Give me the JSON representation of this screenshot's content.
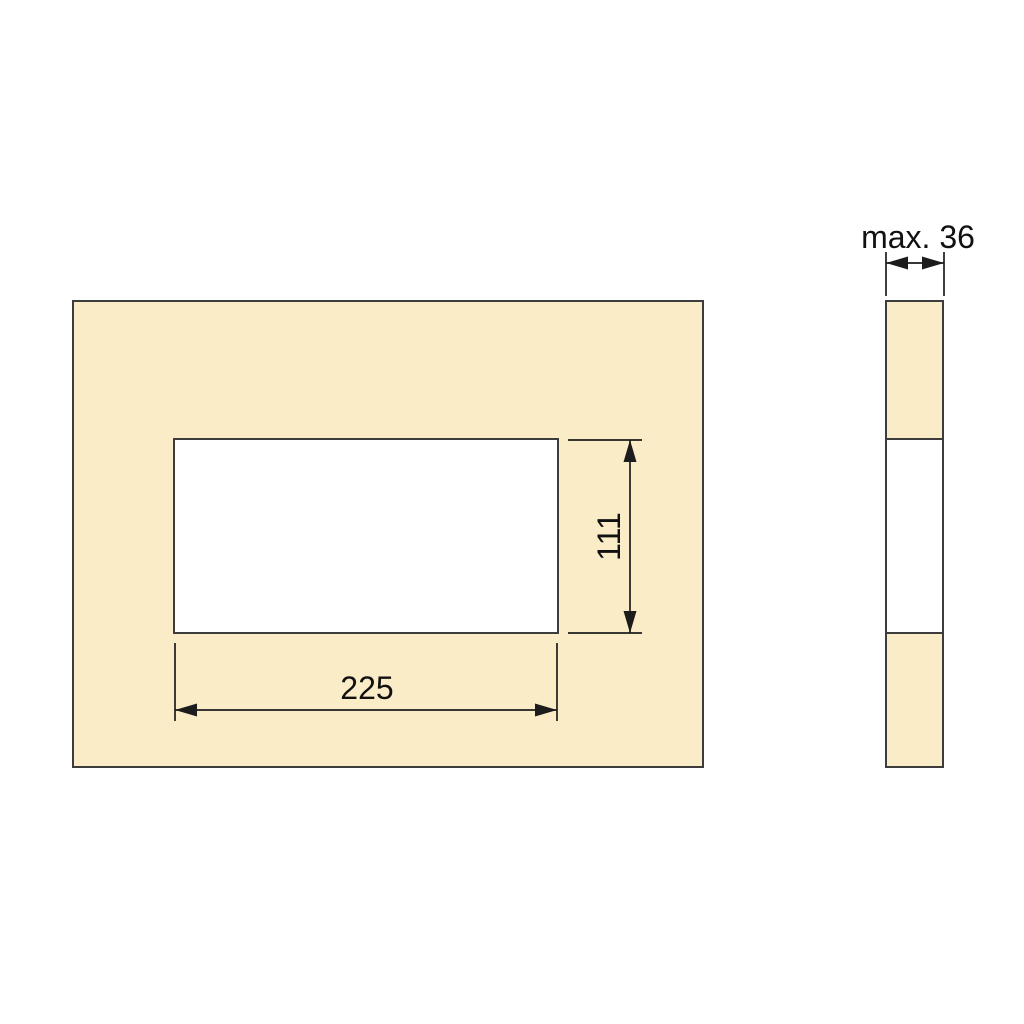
{
  "drawing": {
    "front_view": {
      "cutout_width_label": "225",
      "cutout_height_label": "111"
    },
    "side_view": {
      "thickness_label": "max. 36"
    }
  },
  "colors": {
    "panel_fill": "#FBECC8",
    "cutout_fill": "#FFFFFF",
    "outline": "#3C3C3C",
    "dimension_line": "#1C1C1C",
    "text": "#111111",
    "background": "#FFFFFF"
  }
}
